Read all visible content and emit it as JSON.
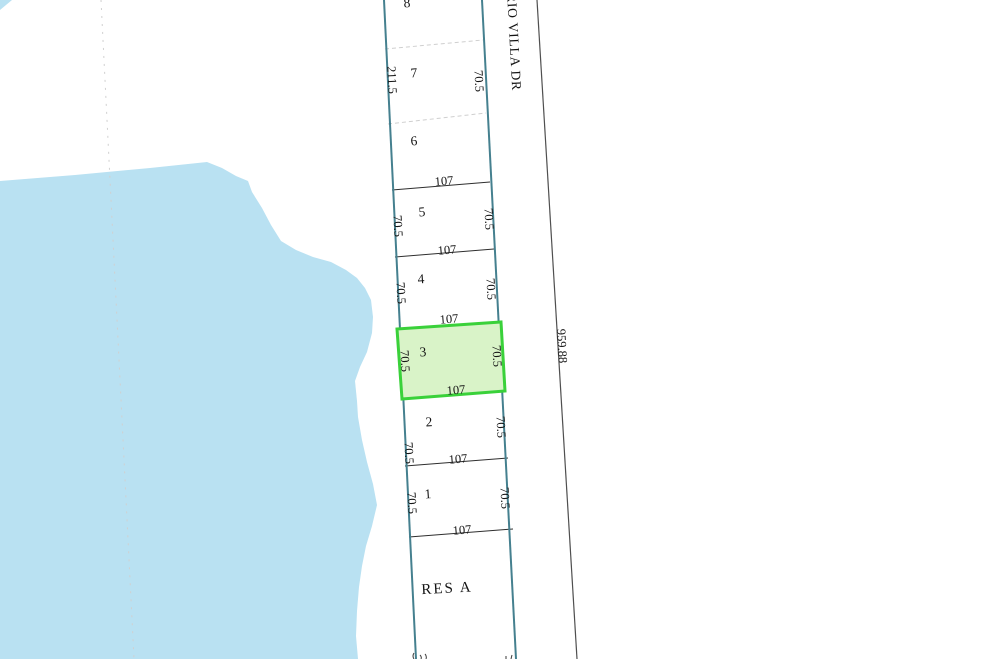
{
  "map": {
    "road": {
      "name": "RIO VILLA DR",
      "frontage_dimension": "959.88"
    },
    "lot_numbers": [
      "8",
      "7",
      "6",
      "5",
      "4",
      "3",
      "2",
      "1"
    ],
    "reserve_label": "RES A",
    "dimensions": {
      "lot_front": "107",
      "lot_side": "70.5",
      "west_boundary": "211.5"
    },
    "highlight": {
      "selected_lot": "3",
      "fill_color": "#d9f3c8",
      "border_color": "#3ad13a"
    },
    "colors": {
      "water": "#b9e1f2",
      "parcel_boundary": "#45808f",
      "lot_line": "#2e2e2e",
      "road_edge": "#4f4f4f",
      "faint_dashed_line": "#d0d0d0",
      "label_text": "#141414"
    }
  }
}
